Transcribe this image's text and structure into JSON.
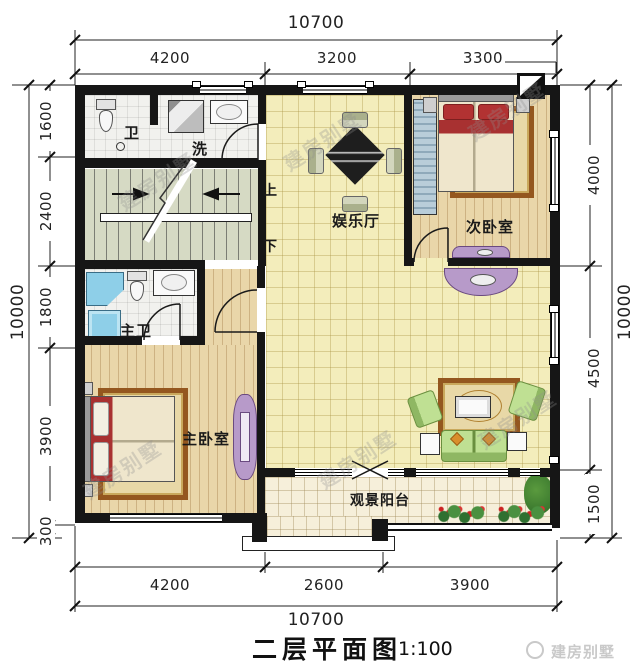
{
  "title": {
    "text": "二层平面图",
    "scale": "1:100"
  },
  "brand": {
    "logo_text": "建房别墅"
  },
  "watermark": {
    "text": "建房别墅"
  },
  "rooms": {
    "bathroom": "卫",
    "laundry": "洗",
    "hall": "娱乐厅",
    "bedroom2": "次卧室",
    "master_bath": "主卫",
    "master_bedroom": "主卧室",
    "balcony": "观景阳台"
  },
  "stairs": {
    "up": "上",
    "down": "下"
  },
  "dimensions": {
    "top": {
      "total": "10700",
      "segments": [
        "4200",
        "3200",
        "3300"
      ]
    },
    "bottom": {
      "total": "10700",
      "segments": [
        "4200",
        "2600",
        "3900"
      ]
    },
    "left": {
      "total": "10000",
      "segments": [
        "1600",
        "2400",
        "1800",
        "3900",
        "300"
      ]
    },
    "right": {
      "total": "10000",
      "segments": [
        "4000",
        "4500",
        "1500"
      ]
    }
  }
}
